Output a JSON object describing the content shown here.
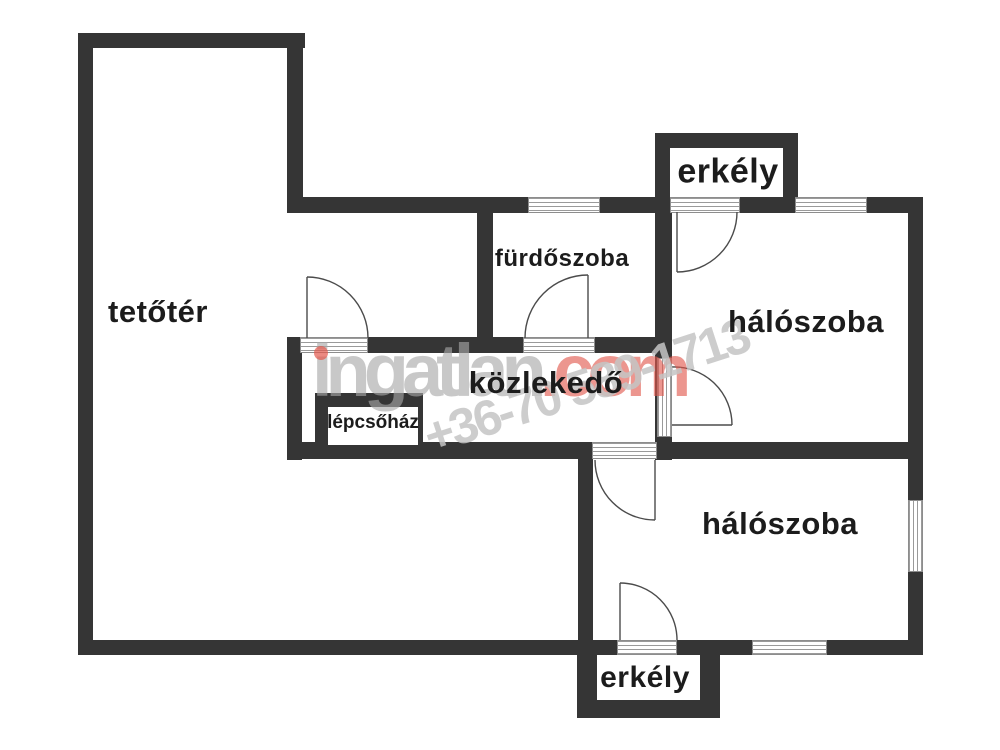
{
  "plan": {
    "type": "floor-plan",
    "language": "hu",
    "rooms": [
      {
        "id": "tetoter",
        "label": "tetőtér"
      },
      {
        "id": "furdoszoba",
        "label": "fürdőszoba"
      },
      {
        "id": "erkely-top",
        "label": "erkély"
      },
      {
        "id": "haloszoba-top",
        "label": "hálószoba"
      },
      {
        "id": "kozlekedo",
        "label": "közlekedő"
      },
      {
        "id": "lepcsohaz",
        "label": "lépcsőház"
      },
      {
        "id": "haloszoba-bottom",
        "label": "hálószoba"
      },
      {
        "id": "erkely-bottom",
        "label": "erkély"
      }
    ],
    "watermark": {
      "brand": "ingatlan",
      "brand_suffix": ".com",
      "phone": "+36-70 589-1713"
    },
    "colors": {
      "wall": "#353535",
      "label": "#1c1c1c",
      "door": "#4b4b4b",
      "window_line": "#9a9a9a",
      "watermark_gray": "#a8a8a8",
      "watermark_red": "#e2574c",
      "phone_gray": "#c5c5c5"
    }
  }
}
